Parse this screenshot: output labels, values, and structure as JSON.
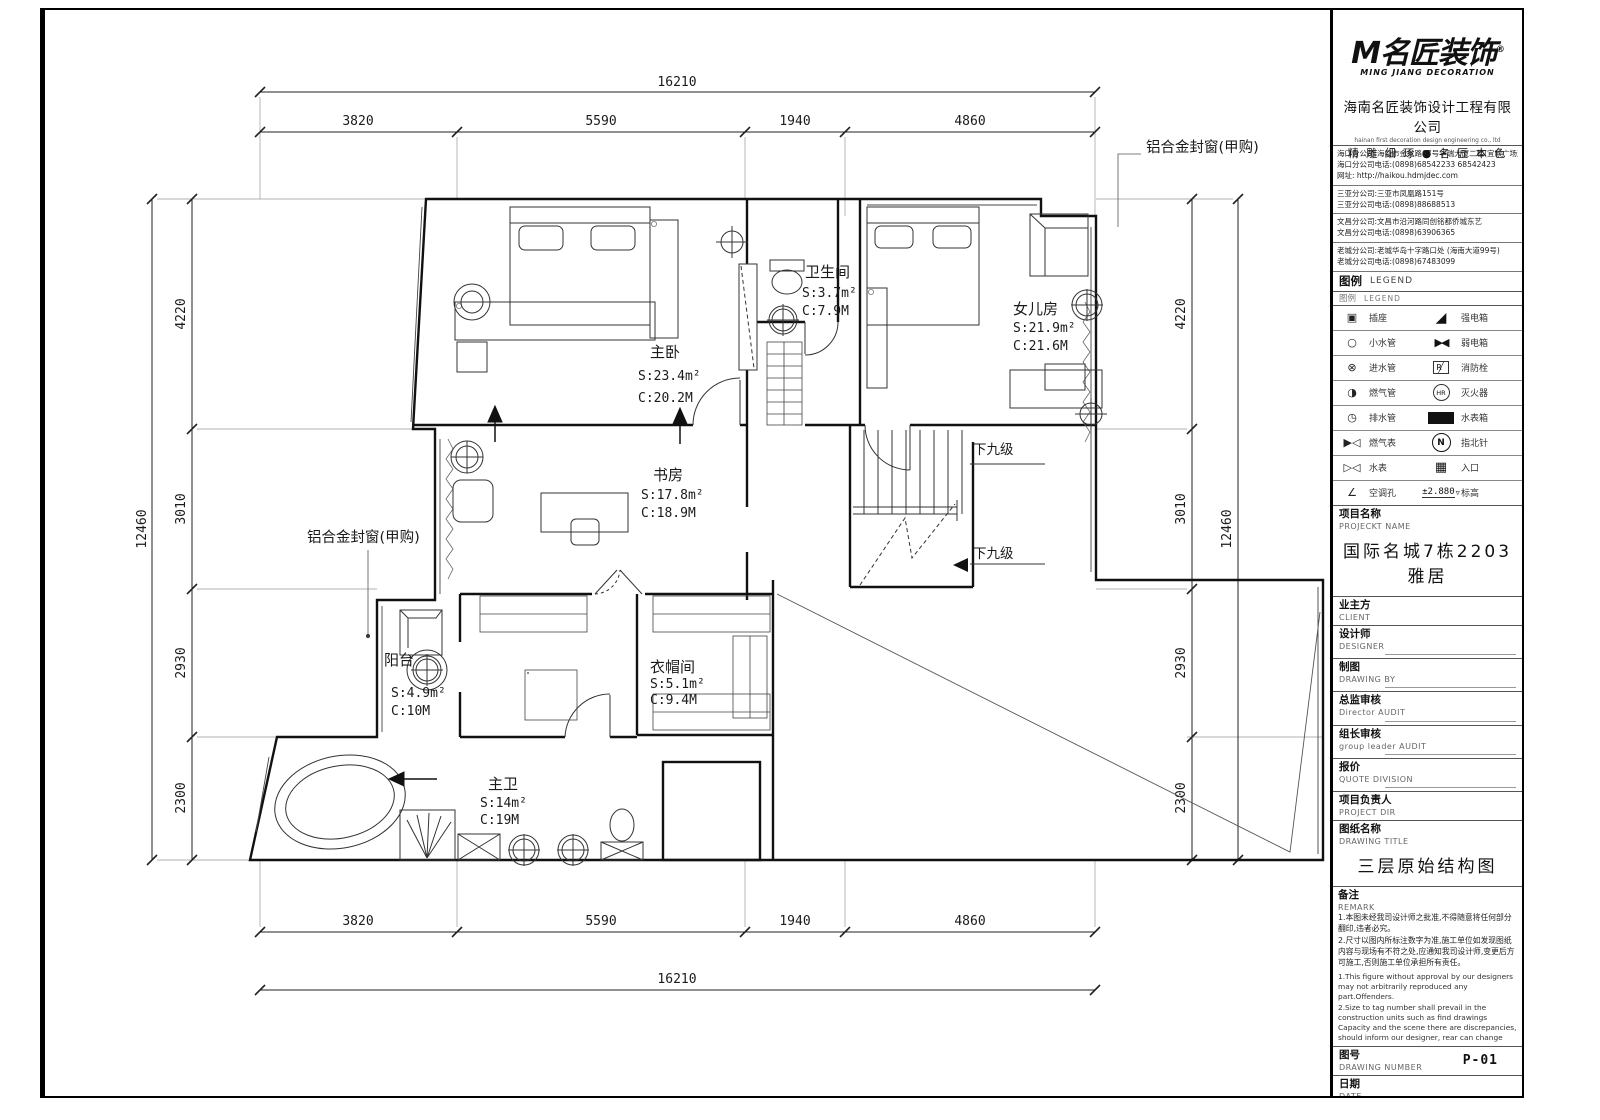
{
  "plan": {
    "rooms": {
      "master_bed": {
        "name": "主卧",
        "s": "S:23.4m²",
        "c": "C:20.2M"
      },
      "bath_small": {
        "name": "卫生间",
        "s": "S:3.7m²",
        "c": "C:7.9M"
      },
      "daughter": {
        "name": "女儿房",
        "s": "S:21.9m²",
        "c": "C:21.6M"
      },
      "study": {
        "name": "书房",
        "s": "S:17.8m²",
        "c": "C:18.9M"
      },
      "balcony": {
        "name": "阳台",
        "s": "S:4.9m²",
        "c": "C:10M"
      },
      "cloakroom": {
        "name": "衣帽间",
        "s": "S:5.1m²",
        "c": "C:9.4M"
      },
      "master_bath": {
        "name": "主卫",
        "s": "S:14m²",
        "c": "C:19M"
      }
    },
    "stair_label": "下九级",
    "window_label": "铝合金封窗(甲购)",
    "dims": {
      "h_total": "16210",
      "h_segs": [
        "3820",
        "5590",
        "1940",
        "4860"
      ],
      "v_total": "12460",
      "v_segs": [
        "4220",
        "3010",
        "2930",
        "2300"
      ]
    }
  },
  "titleblock": {
    "logo": {
      "mark": "M",
      "name": "名匠装饰",
      "reg": "®",
      "sub": "MING JIANG DECORATION"
    },
    "company_cn": "海南名匠装饰设计工程有限公司",
    "company_en": "hainan first decoration design engineering co., ltd",
    "slogan": "精 雕 细 琢 ● 名 匠 本 色",
    "addresses": [
      {
        "l1": "海口分公司:海口市金龙路67号华瑞大厦二楼(宜欣广场对面)",
        "l2": "海口分公司电话:(0898)68542233 68542423",
        "l3": "网址: http://haikou.hdmjdec.com"
      },
      {
        "l1": "三亚分公司:三亚市凤凰路151号",
        "l2": "三亚分公司电话:(0898)88688513",
        "l3": ""
      },
      {
        "l1": "文昌分公司:文昌市沿河路同创铭都侨城东艺",
        "l2": "文昌分公司电话:(0898)63906365",
        "l3": ""
      },
      {
        "l1": "老城分公司:老城华岛十字路口处 (海南大道99号)",
        "l2": "老城分公司电话:(0898)67483099",
        "l3": ""
      }
    ],
    "legend": {
      "title": "图例",
      "title_en": "LEGEND",
      "sub_title": "图例",
      "sub_title_en": "LEGEND",
      "elev_tri": "▽",
      "rows": [
        {
          "l_sym": "▣",
          "l": "插座",
          "r_sym": "◢",
          "r": "强电箱"
        },
        {
          "l_sym": "○",
          "l": "小水管",
          "r_sym": "▶◀",
          "r": "弱电箱"
        },
        {
          "l_sym": "⊗",
          "l": "进水管",
          "r_sym": "R",
          "r": "消防栓"
        },
        {
          "l_sym": "◑",
          "l": "燃气管",
          "r_sym": "HR",
          "r": "灭火器"
        },
        {
          "l_sym": "◷",
          "l": "排水管",
          "r_sym": "",
          "r": "水表箱"
        },
        {
          "l_sym": "▶◁",
          "l": "燃气表",
          "r_sym": "N",
          "r": "指北针"
        },
        {
          "l_sym": "▷◁",
          "l": "水表",
          "r_sym": "▦",
          "r": "入口"
        },
        {
          "l_sym": "∠",
          "l": "空调孔",
          "r_sym": "±2.880",
          "r": "标高"
        }
      ]
    },
    "fields": [
      {
        "label": "项目名称",
        "en": "PROJECKT NAME",
        "value": "国际名城7栋2203雅居"
      },
      {
        "label": "业主方",
        "en": "CLIENT",
        "value": ""
      },
      {
        "label": "设计师",
        "en": "DESIGNER",
        "value": ""
      },
      {
        "label": "制图",
        "en": "DRAWING BY",
        "value": ""
      },
      {
        "label": "总监审核",
        "en": "Director AUDIT",
        "value": ""
      },
      {
        "label": "组长审核",
        "en": "group leader AUDIT",
        "value": ""
      },
      {
        "label": "报价",
        "en": "QUOTE DIVISION",
        "value": ""
      },
      {
        "label": "项目负责人",
        "en": "PROJECT DIR",
        "value": ""
      },
      {
        "label": "图纸名称",
        "en": "DRAWING TITLE",
        "value": "三层原始结构图"
      },
      {
        "label": "备注",
        "en": "REMARK",
        "value": ""
      },
      {
        "label": "图号",
        "en": "DRAWING NUMBER",
        "value": "P-01"
      },
      {
        "label": "日期",
        "en": "DATE",
        "value": ""
      },
      {
        "label": "比例",
        "en": "SCALE",
        "value": "1:75"
      },
      {
        "label": "序号",
        "en": "NUMBER",
        "value": "05"
      }
    ],
    "remark_cn": [
      "1.本图未经我司设计师之批准,不得随意将任何部分翻印,违者必究。",
      "2.尺寸以图内所标注数字为准,施工单位如发现图纸内容与现场有不符之处,应通知我司设计师,变更后方可施工,否则施工单位承担所有责任。"
    ],
    "remark_en": [
      "1.This figure without approval by our designers may not arbitrarily reproduced any part.Offenders.",
      "2.Size to tag number shall prevail in the construction units such as find drawings Capacity and the scene there are discrepancies, should inform our designer, rear can change"
    ]
  }
}
